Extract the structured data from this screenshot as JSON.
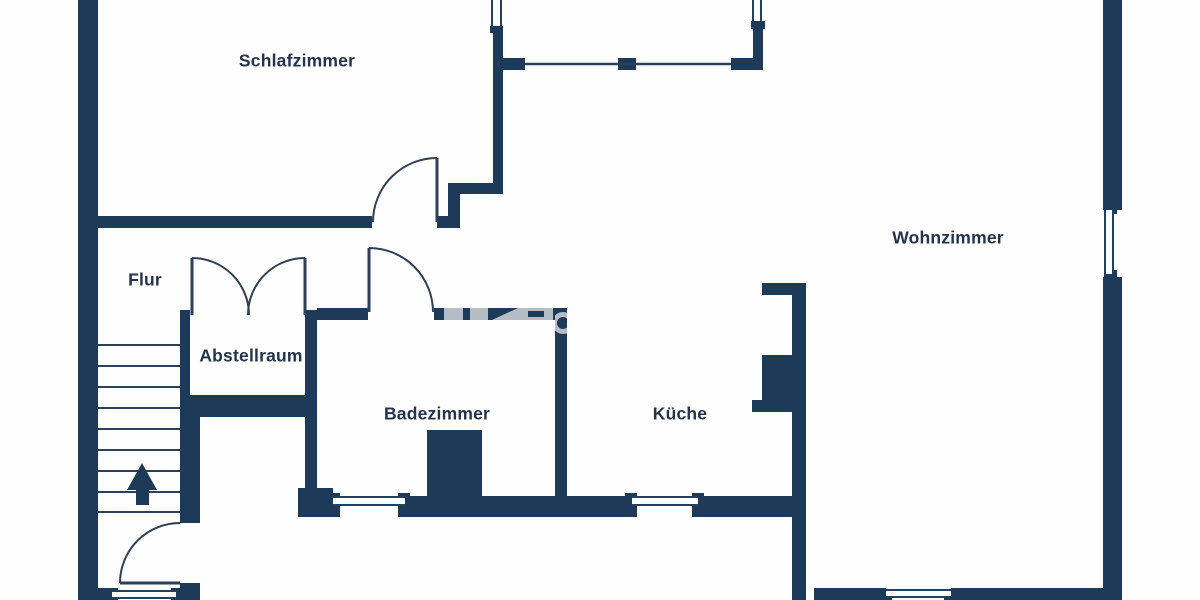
{
  "plan": {
    "type": "floor-plan",
    "language": "de"
  },
  "colors": {
    "wall": "#1e3a59",
    "thin_line": "#2e3f58",
    "background": "#fefefe",
    "label_text": "#24344d",
    "watermark": "#b5bcc6"
  },
  "rooms": [
    {
      "label": "Schlafzimmer"
    },
    {
      "label": "Flur"
    },
    {
      "label": "Abstellraum"
    },
    {
      "label": "Badezimmer"
    },
    {
      "label": "Küche"
    },
    {
      "label": "Wohnzimmer"
    }
  ],
  "stairs": {
    "step_count": 9,
    "arrow_direction": "up"
  },
  "openings": {
    "doors_single": 4,
    "doors_double": 1,
    "windows": 7,
    "railing_segments": 1
  }
}
